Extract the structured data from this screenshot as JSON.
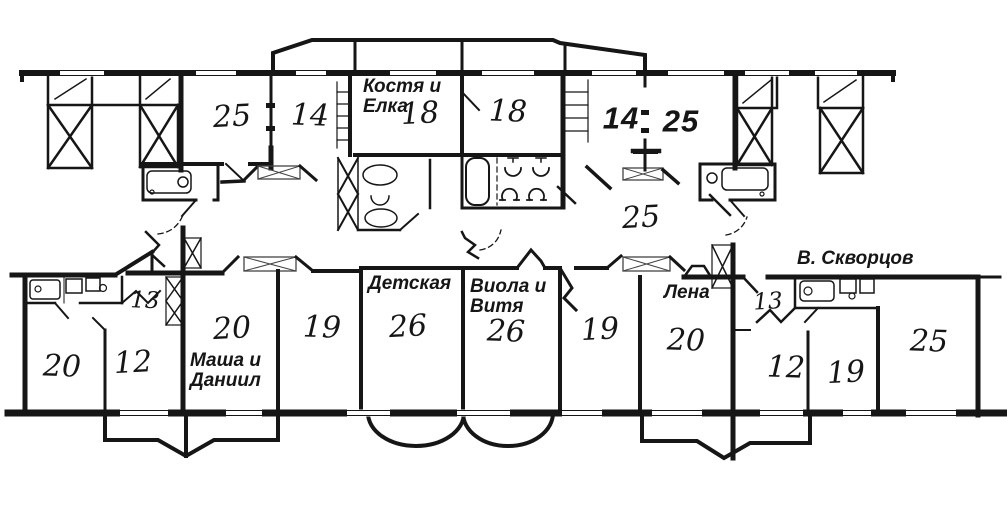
{
  "paper_color": "#ffffff",
  "ink_color": "#161616",
  "rooms_top": [
    {
      "number": "25"
    },
    {
      "number": "14"
    },
    {
      "number": "18"
    },
    {
      "number": "18"
    },
    {
      "number": "14"
    },
    {
      "number": "25"
    }
  ],
  "room_middle": {
    "number": "25"
  },
  "rooms_bottom": [
    {
      "number": "20"
    },
    {
      "number": "12"
    },
    {
      "number": "13"
    },
    {
      "number": "20"
    },
    {
      "number": "19"
    },
    {
      "number": "26"
    },
    {
      "number": "26"
    },
    {
      "number": "19"
    },
    {
      "number": "20"
    },
    {
      "number": "13"
    },
    {
      "number": "12"
    },
    {
      "number": "19"
    },
    {
      "number": "25"
    }
  ],
  "labels": {
    "kostya": "Костя и\nЕлка",
    "detskaya": "Детская",
    "viola": "Виола и\nВитя",
    "lena": "Лена",
    "skvortsov": "В. Скворцов",
    "masha": "Маша и\nДаниил"
  }
}
